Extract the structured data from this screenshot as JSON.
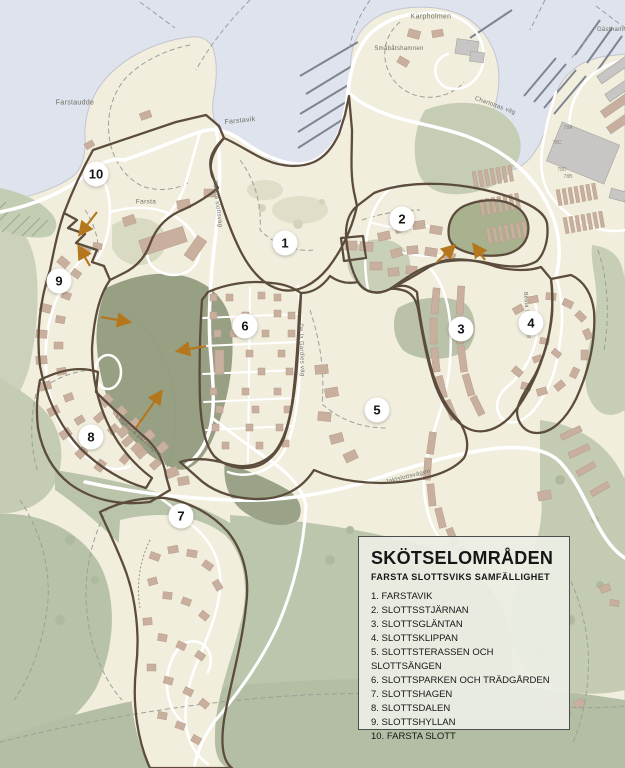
{
  "map": {
    "labels": {
      "farstaudde": "Farstaudde",
      "farstavik": "Farstavik",
      "karpholmen": "Karpholmen",
      "smabatshamnen": "Småbåtshamnen",
      "gasthamn": "Gästhamn",
      "farsta": "Farsta",
      "farsta_slottsvag": "Farsta slottsväg",
      "charlottas_vag": "Charlottas väg",
      "de_la_gardies_vag": "De la Gardies väg",
      "engelska_parkvagen": "Engelska parkvägen",
      "jaktslottsvagen": "Jaktslottsvägen",
      "beata_sofias_vag": "Beata Sofias väg"
    },
    "markers": [
      "1",
      "2",
      "3",
      "4",
      "5",
      "6",
      "7",
      "8",
      "9",
      "10"
    ],
    "building_numbers": [
      "78A",
      "78C",
      "78D",
      "78B"
    ],
    "colors": {
      "water": "#dfe3ed",
      "land": "#f2eede",
      "field_green": "#bac4ab",
      "park_dark_green": "#98a084",
      "boundary_brown": "#5c4c3c",
      "arrow_orange": "#b5771d",
      "building_tan": "#c9af9e",
      "road_white": "#ffffff"
    }
  },
  "legend": {
    "title": "SKÖTSELOMRÅDEN",
    "subtitle": "FARSTA SLOTTSVIKS SAMFÄLLIGHET",
    "items": [
      "1. FARSTAVIK",
      "2. SLOTTSSTJÄRNAN",
      "3. SLOTTSGLÄNTAN",
      "4. SLOTTSKLIPPAN",
      "5. SLOTTSTERASSEN OCH SLOTTSÄNGEN",
      "6. SLOTTSPARKEN OCH TRÄDGÅRDEN",
      "7. SLOTTSHAGEN",
      "8. SLOTTSDALEN",
      "9. SLOTTSHYLLAN",
      "10. FARSTA SLOTT"
    ]
  }
}
